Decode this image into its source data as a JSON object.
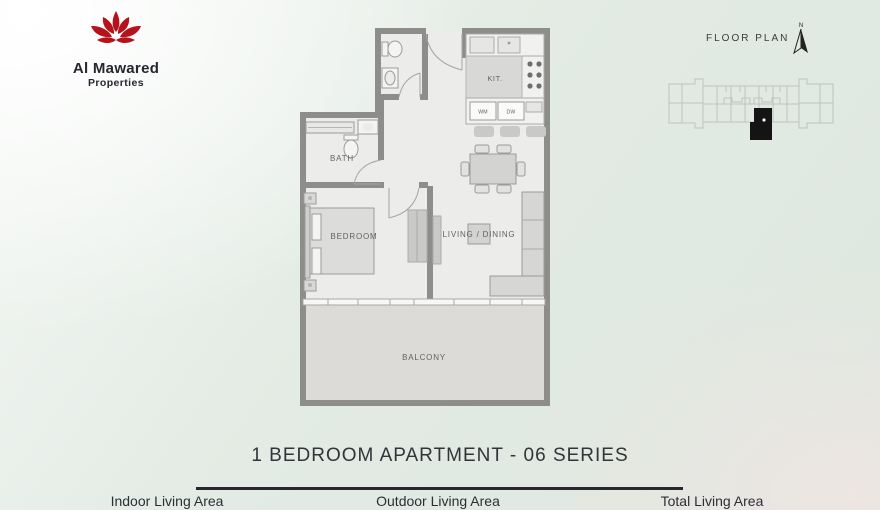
{
  "brand": {
    "name": "Al Mawared",
    "tagline": "Properties"
  },
  "header": {
    "floor_plan_label": "FLOOR PLAN",
    "north_label": "N"
  },
  "plan": {
    "rooms": {
      "kitchen": "KIT.",
      "bath": "BATH",
      "bedroom": "BEDROOM",
      "living_dining": "LIVING / DINING",
      "balcony": "BALCONY",
      "washing_machine": "WM",
      "dishwasher": "DW"
    }
  },
  "footer": {
    "title": "1 BEDROOM APARTMENT - 06 SERIES",
    "areas": [
      {
        "label": "Indoor Living Area"
      },
      {
        "label": "Outdoor Living Area"
      },
      {
        "label": "Total Living Area"
      }
    ]
  },
  "colors": {
    "background_green": "#dfe8e1",
    "wall": "#8d8d8b",
    "floor": "#ececea",
    "balcony_floor": "#dcdbd8",
    "furniture": "#d8d8d6",
    "logo_red": "#b5121b",
    "text_dark": "#303036",
    "divider_dark": "#27272c",
    "keyplan_outline": "#bdc4be",
    "keyplan_unit": "#141414"
  }
}
